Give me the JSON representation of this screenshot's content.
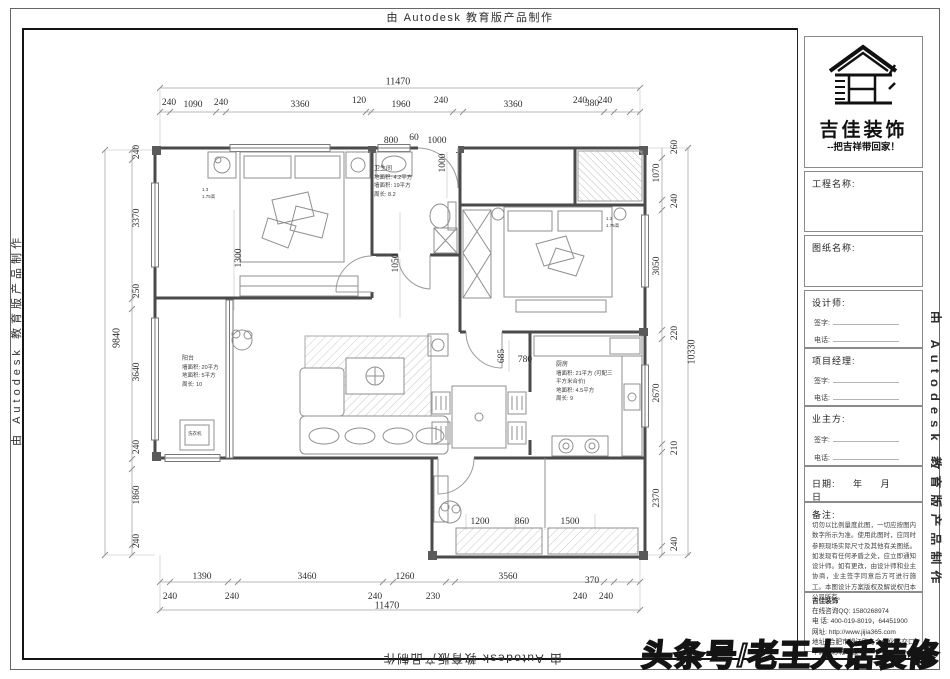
{
  "watermarks": {
    "autodesk": "由 Autodesk 教育版产品制作",
    "headline": "头条号/老王大话装修"
  },
  "dims": {
    "top_total": "11470",
    "top_row": [
      "240",
      "1090",
      "240",
      "3360",
      "120",
      "1960",
      "240",
      "3360",
      "240",
      "380",
      "240"
    ],
    "top_sub": [
      "800",
      "60",
      "1000"
    ],
    "left_total": "9840",
    "left_row": [
      "240",
      "3370",
      "250",
      "3640",
      "240",
      "1860",
      "240"
    ],
    "right_total": "10330",
    "right_row": [
      "260",
      "1070",
      "240",
      "3050",
      "220",
      "2670",
      "210",
      "2370",
      "240"
    ],
    "bottom_row1": [
      "1390",
      "3460",
      "1260",
      "3560",
      "370"
    ],
    "bottom_row2": [
      "240",
      "240",
      "240",
      "230",
      "240",
      "240"
    ],
    "bottom_total": "11470",
    "inner": {
      "a": "1300",
      "b": "1050",
      "c": "1000",
      "d": "685",
      "e": "780",
      "f": "1200",
      "g": "860",
      "h": "1500"
    }
  },
  "rooms": {
    "bathroom": {
      "name": "卫生间",
      "l1": "地面积: 4.2平方",
      "l2": "墙面积: 19平方",
      "l3": "周长: 8.2"
    },
    "balcony": {
      "name": "阳台",
      "l1": "墙面积: 20平方",
      "l2": "地面积: 5平方",
      "l3": "周长: 10"
    },
    "kitchen": {
      "name": "厨房",
      "l1": "墙面积: 21平方 (可配三",
      "l2": "平方米合价)",
      "l3": "地面积: 4.5平方",
      "l4": "周长: 9"
    },
    "washer": "洗衣机",
    "window_note_w": "1.3",
    "window_note_h": "1.75高"
  },
  "title_block": {
    "brand": "吉佳装饰",
    "slogan": "--把吉祥带回家！",
    "project_label": "工程名称:",
    "drawing_label": "图纸名称:",
    "designer_label": "设计师:",
    "pm_label": "项目经理:",
    "owner_label": "业主方:",
    "sign_label": "签字:",
    "phone_label": "电话:",
    "date_label": "日期:",
    "year": "年",
    "month": "月",
    "day": "日",
    "remarks_label": "备注:",
    "remarks": "切勿以比例量度此图，一切应按图内数字所示为准。使用此图时，应同时参照现场实际尺寸及其他有关图纸。如发现有任何矛盾之处，应立即通知设计师。如有更改，由设计师和业主协商，业主签字同意后方可进行施工。本图设计方案版权及解说权归本公司所有。",
    "company_name": "吉佳装饰",
    "company_qq": "在线咨询QQ: 1580268974",
    "company_tel": "电 话: 400-019-8019，64451900",
    "company_web": "网址: http://www.jijia365.com",
    "company_addr": "地址: 合肥市望江路与合作化路交口华润五彩城11楼"
  }
}
